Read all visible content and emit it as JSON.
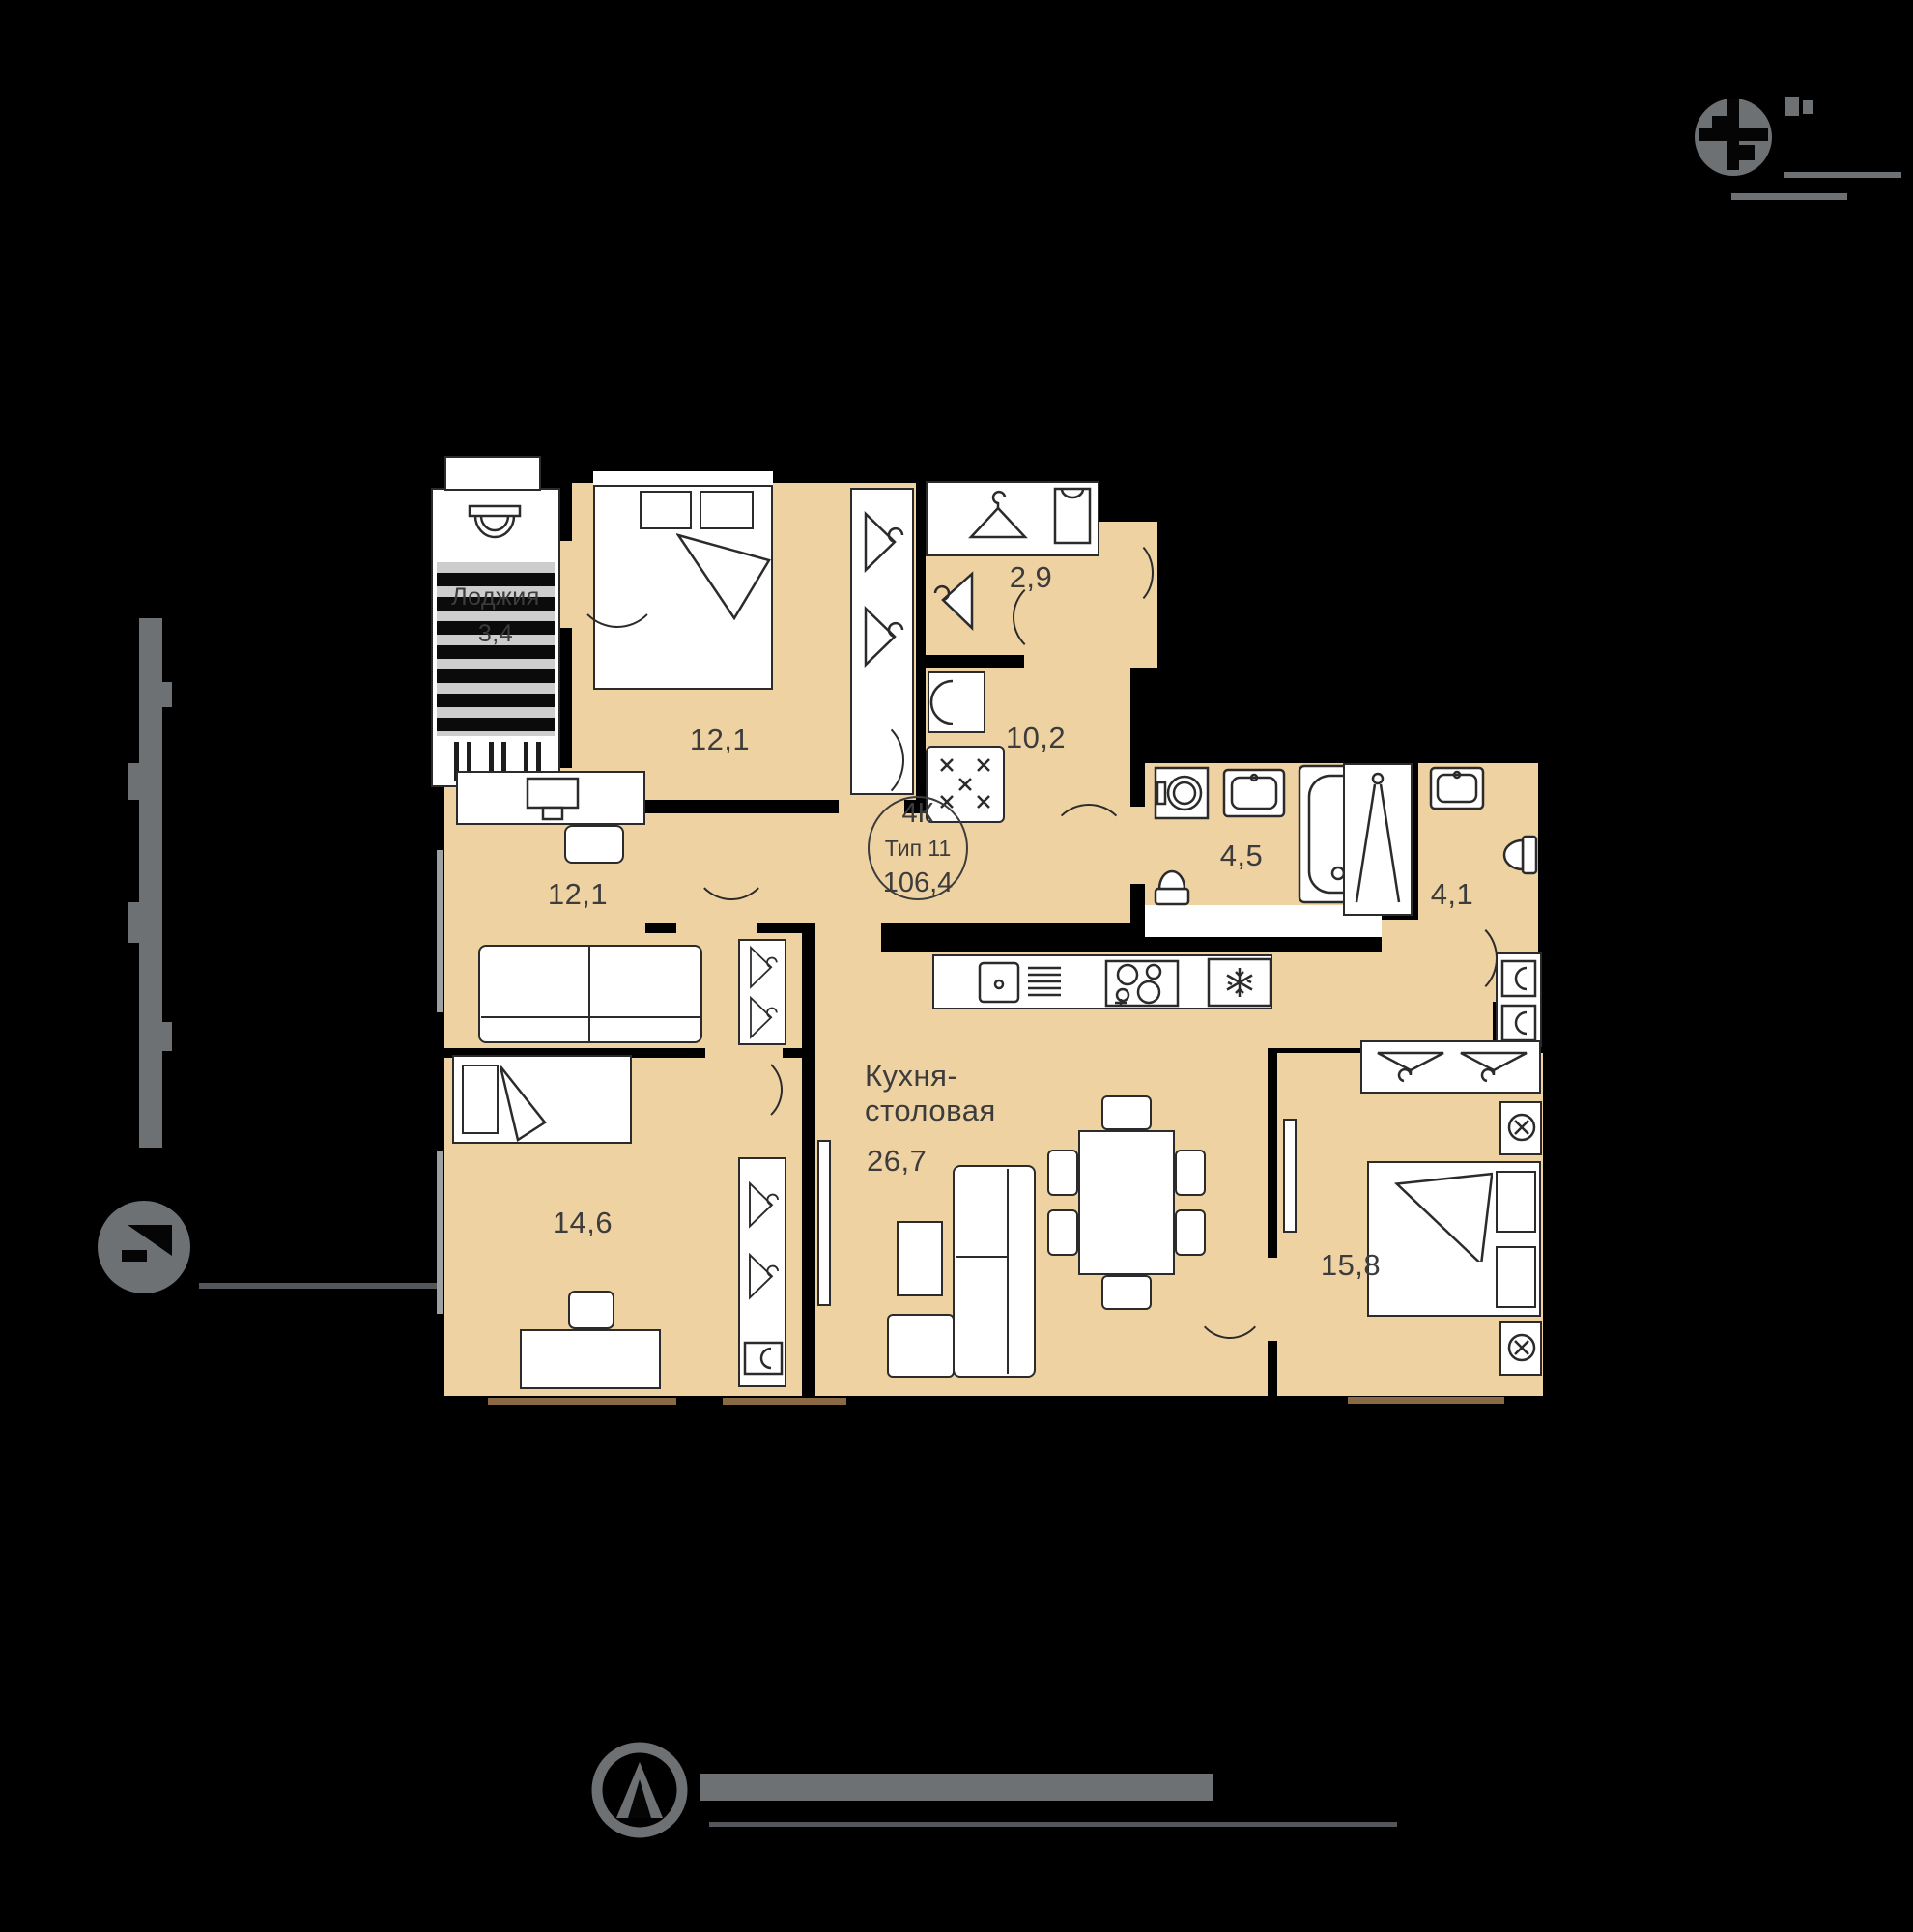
{
  "plan_badge": {
    "rooms": "4К",
    "type": "Тип 11",
    "total_area": "106,4"
  },
  "rooms": {
    "bedroom_top": {
      "area": "12,1"
    },
    "dressing": {
      "area": "2,9"
    },
    "hall": {
      "area": "10,2"
    },
    "office": {
      "area": "12,1"
    },
    "bathroom": {
      "area": "4,5"
    },
    "shower_room": {
      "area": "4,1"
    },
    "children_room": {
      "area": "14,6"
    },
    "kitchen_dining": {
      "name_line1": "Кухня-",
      "name_line2": "столовая",
      "area": "26,7"
    },
    "bedroom_master": {
      "area": "15,8"
    },
    "loggia": {
      "name": "Лоджия",
      "area": "3,4"
    }
  },
  "colors": {
    "background": "#000000",
    "floor": "#efd2a2",
    "outline": "#2b2b2b",
    "label": "#3c3c3c",
    "context": "#6e7173",
    "sill": "#8a6a45"
  }
}
